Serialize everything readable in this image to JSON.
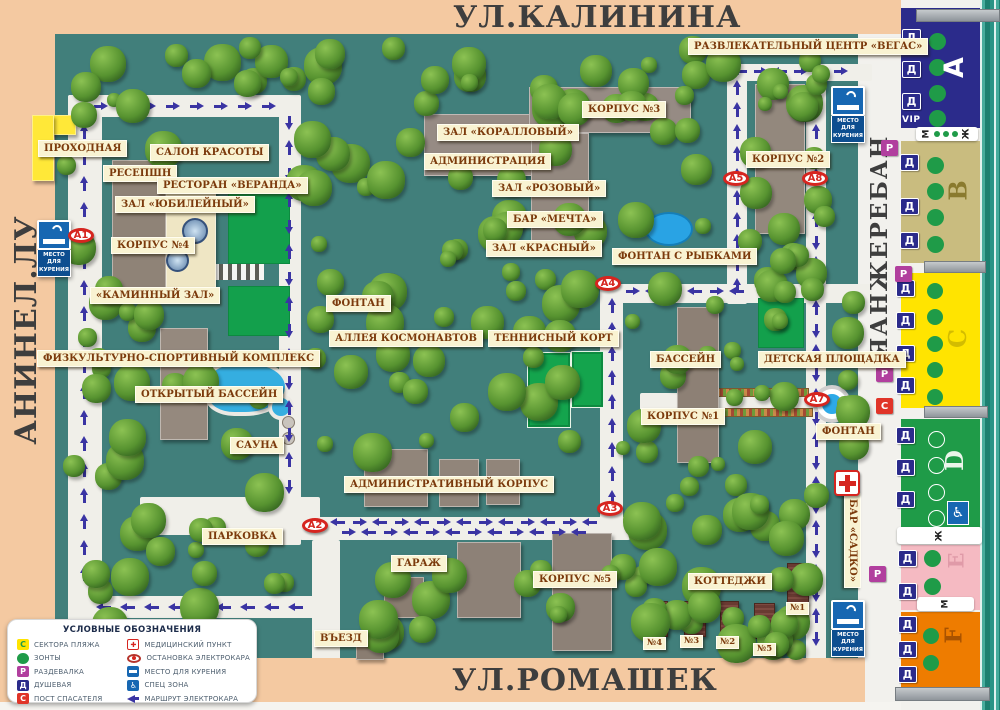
{
  "streets": {
    "top": "УЛ.КАЛИНИНА",
    "left": "УЛ.ЛЕНИНА",
    "bottom": "УЛ.РОМАШЕК",
    "right": "НАБЕРЕЖНАЯ"
  },
  "places": {
    "vegas": "РАЗВЛЕКАТЕЛЬНЫЙ ЦЕНТР «ВЕГАС»",
    "prohodnaya": "ПРОХОДНАЯ",
    "salon": "САЛОН КРАСОТЫ",
    "resepshn": "РЕСЕПШН",
    "veranda": "РЕСТОРАН «ВЕРАНДА»",
    "yubileyny": "ЗАЛ «ЮБИЛЕЙНЫЙ»",
    "korpus4": "КОРПУС №4",
    "kaminny": "«КАМИННЫЙ ЗАЛ»",
    "fizkult": "ФИЗКУЛЬТУРНО-СПОРТИВНЫЙ КОМПЛЕКС",
    "basseyn_open": "ОТКРЫТЫЙ БАССЕЙН",
    "sauna": "САУНА",
    "parkovka": "ПАРКОВКА",
    "korallovy": "ЗАЛ «КОРАЛЛОВЫЙ»",
    "administratsiya": "АДМИНИСТРАЦИЯ",
    "rozovy": "ЗАЛ «РОЗОВЫЙ»",
    "mechta": "БАР «МЕЧТА»",
    "krasny": "ЗАЛ «КРАСНЫЙ»",
    "korpus3": "КОРПУС №3",
    "korpus2": "КОРПУС №2",
    "fontan_rybki": "ФОНТАН С РЫБКАМИ",
    "fontan1": "ФОНТАН",
    "alleya": "АЛЛЕЯ КОСМОНАВТОВ",
    "tennis": "ТЕННИСНЫЙ КОРТ",
    "basseyn": "БАССЕЙН",
    "detskaya": "ДЕТСКАЯ ПЛОЩАДКА",
    "korpus1": "КОРПУС №1",
    "fontan2": "ФОНТАН",
    "admin_korpus": "АДМИНИСТРАТИВНЫЙ КОРПУС",
    "garazh": "ГАРАЖ",
    "korpus5": "КОРПУС №5",
    "kottedzhi": "КОТТЕДЖИ",
    "vezd": "ВЪЕЗД",
    "sadko": "БАР «САДКО»",
    "cottage1": "№1",
    "cottage2": "№2",
    "cottage3": "№3",
    "cottage4": "№4",
    "cottage5": "№5"
  },
  "stops": {
    "a1": "А1",
    "a2": "А2",
    "a3": "А3",
    "a4": "А4",
    "a5": "А5",
    "a7": "А7",
    "a8": "А8"
  },
  "smoking_sign": {
    "line1": "МЕСТО ДЛЯ",
    "line2": "КУРЕНИЯ"
  },
  "beach": {
    "vip": "VIP",
    "badge_d": "Д",
    "badge_p": "Р",
    "badge_s": "С",
    "wc_male": "М",
    "wc_female": "Ж",
    "sectors": [
      {
        "letter": "А"
      },
      {
        "letter": "В"
      },
      {
        "letter": "С"
      },
      {
        "letter": "D"
      },
      {
        "letter": "Е"
      },
      {
        "letter": "F"
      }
    ]
  },
  "legend": {
    "title": "УСЛОВНЫЕ ОБОЗНАЧЕНИЯ",
    "left": [
      {
        "icon": "sector",
        "letter": "С",
        "label": "СЕКТОРА ПЛЯЖА"
      },
      {
        "icon": "umbrella",
        "label": "ЗОНТЫ"
      },
      {
        "icon": "changing",
        "letter": "Р",
        "label": "РАЗДЕВАЛКА"
      },
      {
        "icon": "shower",
        "letter": "Д",
        "label": "ДУШЕВАЯ"
      },
      {
        "icon": "lifeguard",
        "letter": "С",
        "label": "ПОСТ СПАСАТЕЛЯ"
      }
    ],
    "right": [
      {
        "icon": "medical",
        "label": "МЕДИЦИНСКИЙ ПУНКТ"
      },
      {
        "icon": "stop",
        "label": "ОСТАНОВКА ЭЛЕКТРОКАРА"
      },
      {
        "icon": "smoking",
        "label": "МЕСТО ДЛЯ КУРЕНИЯ"
      },
      {
        "icon": "wheelchair",
        "label": "СПЕЦ ЗОНА"
      },
      {
        "icon": "route",
        "label": "МАРШРУТ ЭЛЕКТРОКАРА"
      }
    ]
  },
  "colors": {
    "map_bg": "#417f7b",
    "street_bg": "#f4c9a1",
    "route_blue": "#3a34a3",
    "plaque_bg": "#f9f3d2",
    "plaque_text": "#7b3a0c",
    "sector_a": "#2b2b8b",
    "sector_b": "#c9bc7f",
    "sector_c": "#ffe400",
    "sector_d": "#1f9b48",
    "sector_e": "#f5bac2",
    "sector_f": "#ee7c00",
    "badge_d": "#2b2b8b",
    "badge_p": "#b13f9e",
    "badge_s": "#e03428",
    "umbrella_green": "#1f9b48",
    "stop_red": "#d6251f"
  }
}
